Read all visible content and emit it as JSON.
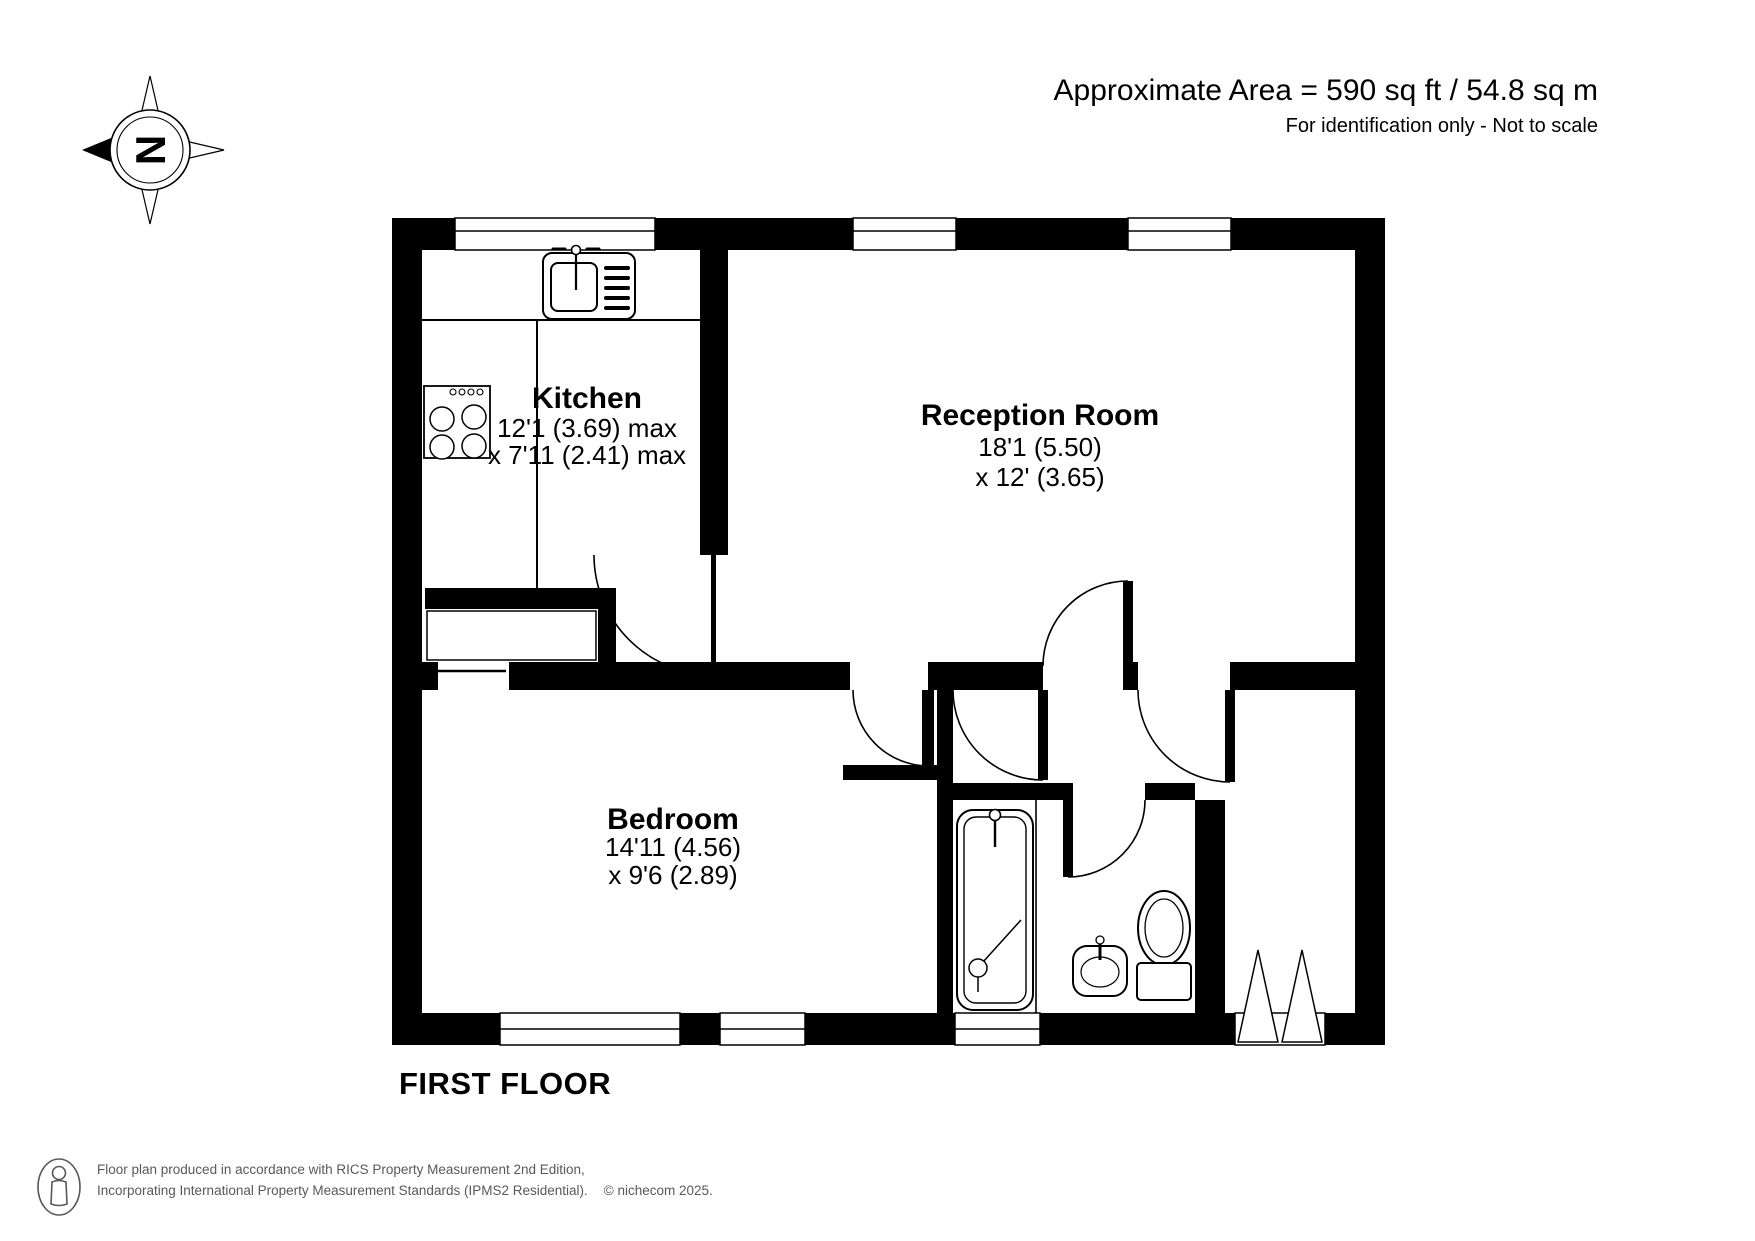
{
  "header": {
    "area_line1": "Approximate Area = 590 sq ft / 54.8 sq m",
    "area_line2": "For identification only - Not to scale"
  },
  "compass": {
    "north_letter": "N"
  },
  "rooms": {
    "kitchen": {
      "name": "Kitchen",
      "dim1": "12'1 (3.69) max",
      "dim2": "x 7'11 (2.41) max"
    },
    "reception": {
      "name": "Reception Room",
      "dim1": "18'1 (5.50)",
      "dim2": "x 12' (3.65)"
    },
    "bedroom": {
      "name": "Bedroom",
      "dim1": "14'11 (4.56)",
      "dim2": "x 9'6 (2.89)"
    }
  },
  "floor_label": "FIRST FLOOR",
  "footer": {
    "line1": "Floor plan produced in accordance with RICS Property Measurement 2nd Edition,",
    "line2": "Incorporating International Property Measurement Standards (IPMS2 Residential).",
    "copyright": "© nichecom 2025."
  },
  "icons": [
    "compass-north-icon",
    "person-icon",
    "kitchen-sink-icon",
    "hob-icon",
    "bath-icon",
    "shower-icon",
    "basin-icon",
    "toilet-icon"
  ],
  "colors": {
    "wall": "#000000",
    "background": "#ffffff",
    "footer_text": "#58595b"
  }
}
